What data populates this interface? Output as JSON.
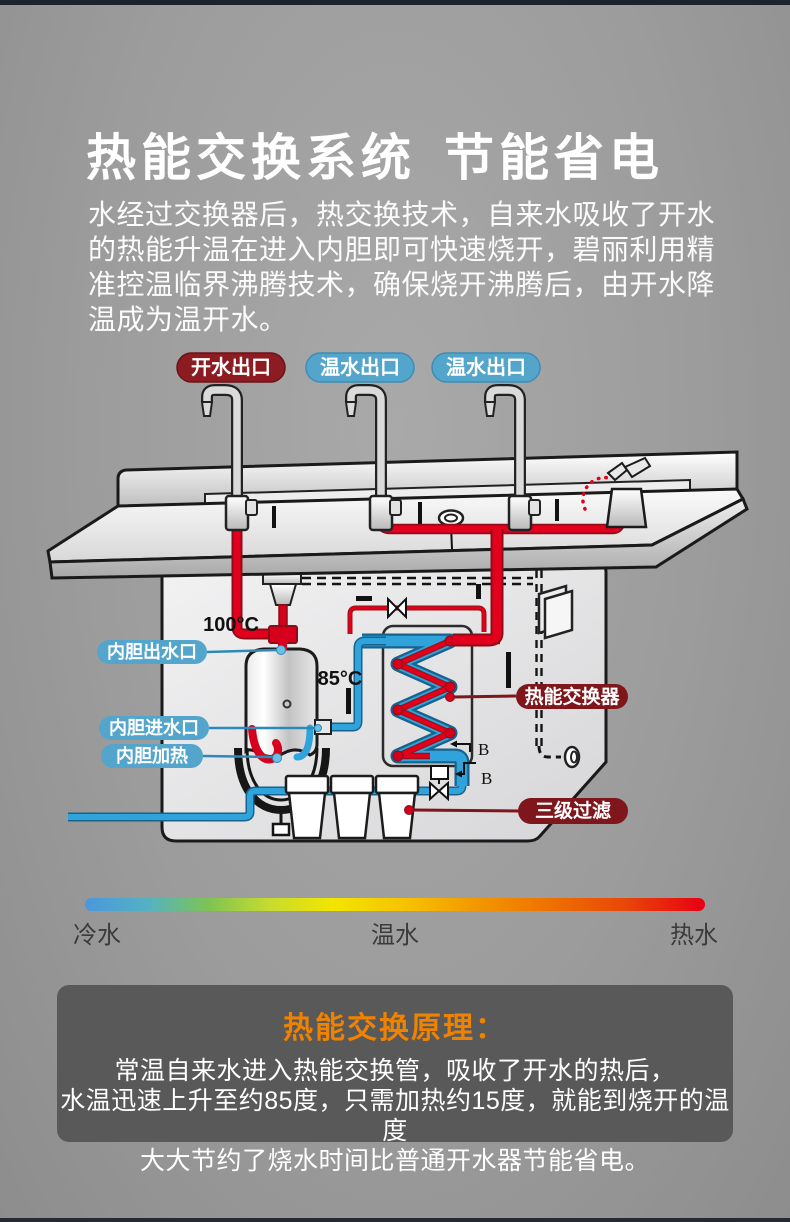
{
  "page": {
    "title": {
      "part1": "热能交换系统",
      "part2": "节能省电"
    },
    "intro": "水经过交换器后，热交换技术，自来水吸收了开水的热能升温在进入内胆即可快速烧开，碧丽利用精准控温临界沸腾技术，确保烧开沸腾后，由开水降温成为温开水。"
  },
  "diagram": {
    "outlets": [
      {
        "label": "开水出口",
        "type": "boiling"
      },
      {
        "label": "温水出口",
        "type": "warm"
      },
      {
        "label": "温水出口",
        "type": "warm"
      }
    ],
    "parts": {
      "tank_outlet": "内胆出水口",
      "tank_inlet": "内胆进水口",
      "tank_heater": "内胆加热",
      "heat_exchanger": "热能交换器",
      "filter": "三级过滤"
    },
    "temperatures": {
      "tank_top": "100°C",
      "preheat": "85°C"
    },
    "markers": {
      "b1": "B",
      "b2": "B"
    }
  },
  "temperature_scale": {
    "cold": "冷水",
    "warm": "温水",
    "hot": "热水"
  },
  "principle": {
    "heading": "热能交换原理：",
    "lines": [
      "常温自来水进入热能交换管，吸收了开水的热后，",
      "水温迅速上升至约85度，只需加热约15度，就能到烧开的温度",
      "大大节约了烧水时间比普通开水器节能省电。"
    ]
  },
  "colors": {
    "hot_pipe": "#e3001c",
    "cold_pipe": "#2fa3da",
    "boiling_label_bg": "#8c1c22",
    "warm_label_bg": "#54a5cc",
    "callout_bg": "#7e161b",
    "principle_heading": "#ef8200",
    "principle_box_bg": "#595959",
    "background": "#9c9c9c"
  }
}
